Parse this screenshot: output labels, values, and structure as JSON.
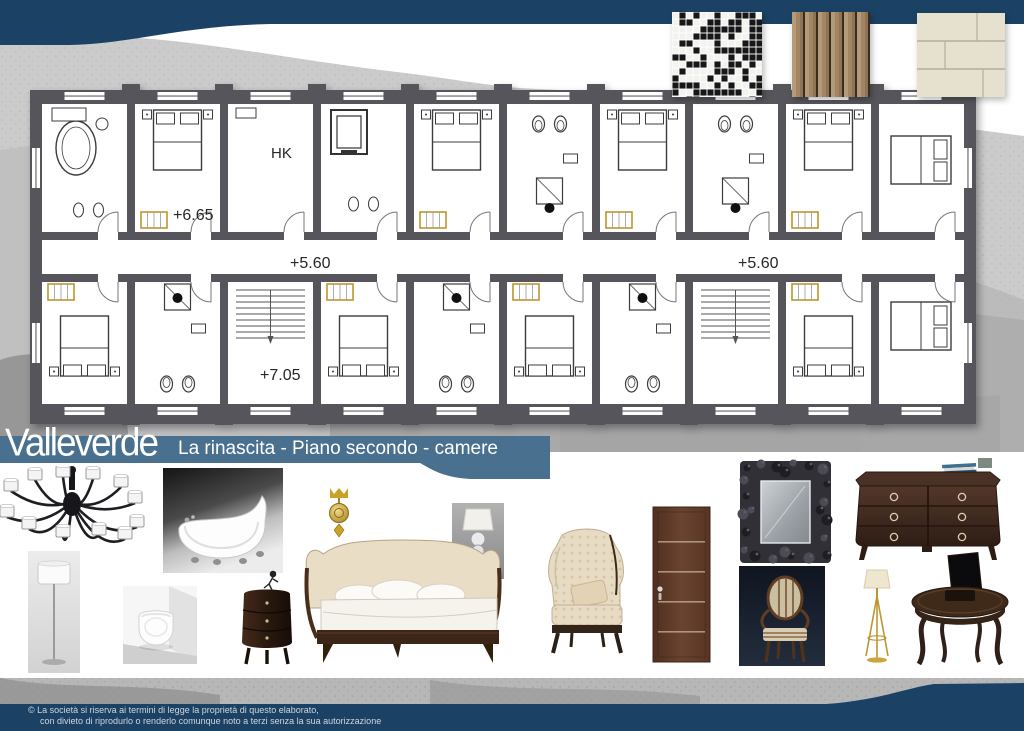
{
  "header": {
    "top_band_color": "#1b4264"
  },
  "title": {
    "brand": "Valleverde",
    "subtitle": "La rinascita - Piano secondo - camere",
    "band_color": "#49708e"
  },
  "plan": {
    "labels": {
      "hk": "HK",
      "level_top": "+6.65",
      "level_corridor_left": "+5.60",
      "level_corridor_right": "+5.60",
      "level_bottom": "+7.05"
    },
    "wall_color": "#55555b",
    "accent_color": "#bd962f"
  },
  "materials": [
    {
      "name": "black-white-mosaic-tile"
    },
    {
      "name": "wood-plank-flooring"
    },
    {
      "name": "beige-stone-tiles"
    }
  ],
  "furniture": [
    "chandelier",
    "clawfoot-bathtub",
    "gold-wall-sconce",
    "table-lamp",
    "brown-door",
    "baroque-mirror",
    "dresser",
    "white-floor-lamp",
    "wall-hung-toilet",
    "round-nightstand",
    "upholstered-bed",
    "wingback-armchair",
    "classic-chair",
    "gold-floor-lamp",
    "oval-desk"
  ],
  "footer": {
    "line1": "© La società si riserva ai termini di legge la proprietà di questo elaborato,",
    "line2": "con divieto di riprodurlo o renderlo comunque noto a terzi senza la sua autorizzazione",
    "bar_color": "#1b4264"
  }
}
